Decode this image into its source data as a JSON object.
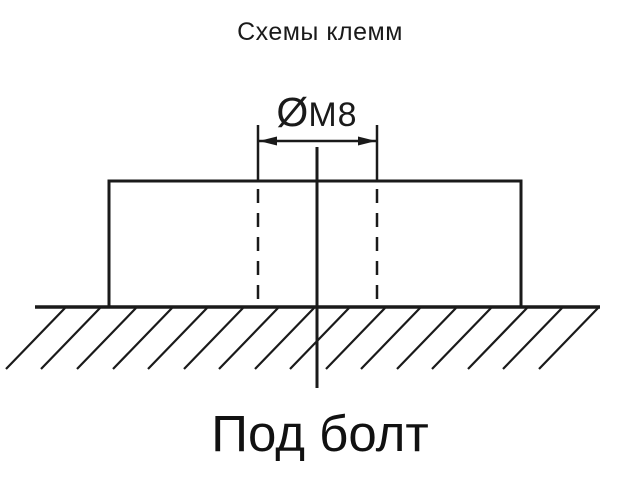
{
  "title": "Схемы клемм",
  "diagram": {
    "dimension": {
      "symbol": "Ø",
      "thread": "M8"
    },
    "caption": "Под болт"
  },
  "colors": {
    "ink": "#1a1a1a",
    "background": "#ffffff"
  }
}
